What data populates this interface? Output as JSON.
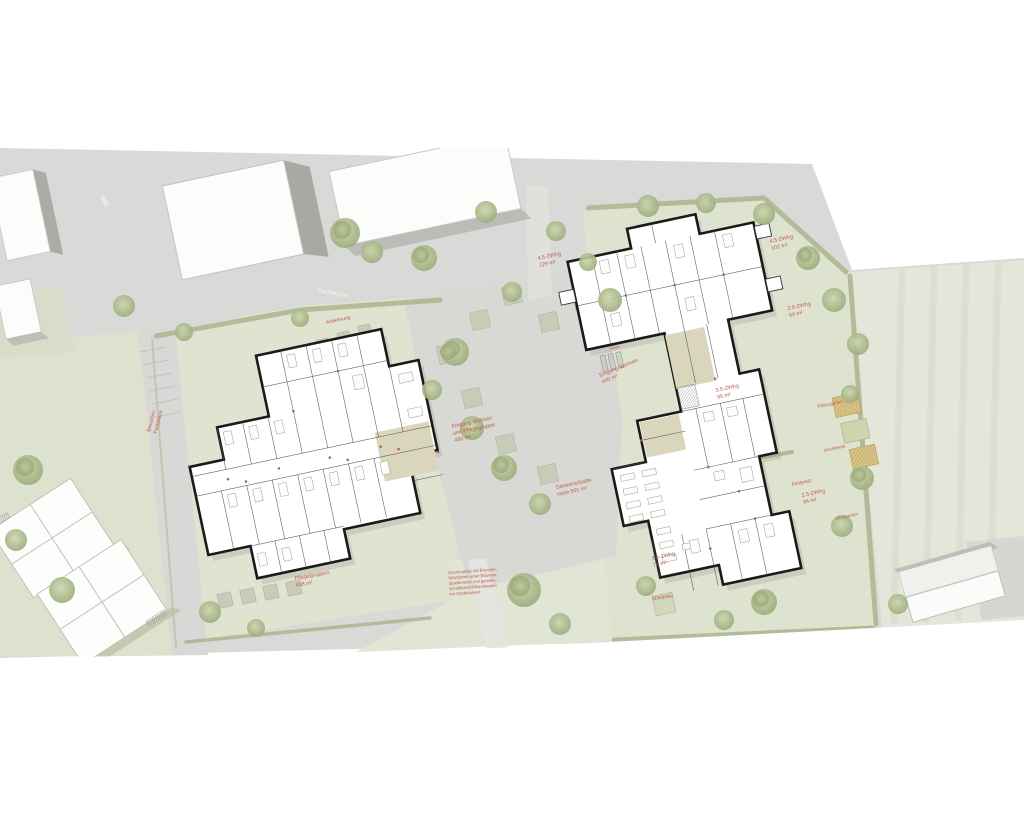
{
  "plan": {
    "street": {
      "name": "Bachstrasse",
      "marking": "460"
    },
    "apartments": [
      {
        "type": "4.5-ZWhg",
        "area": "129 m²"
      },
      {
        "type": "4.5-ZWhg",
        "area": "102 m²"
      },
      {
        "type": "2.5-ZWhg",
        "area": "64 m²"
      },
      {
        "type": "3.5-ZWhg",
        "area": "95 m²"
      },
      {
        "type": "2.5-ZWhg",
        "area": "94 m²"
      },
      {
        "type": "3.5-ZWhg",
        "area": "76 m²"
      }
    ],
    "entrances": {
      "e1": [
        "Eingang Wohnen",
        "und Pflegegruppe",
        "460 m²"
      ],
      "e2": [
        "Eingang Wohnen",
        "440 m²"
      ]
    },
    "facilities": {
      "gemeinschaft": [
        "Gemeinschafts-",
        "raum 501 m²"
      ],
      "pflege": [
        "Pflegegruppen",
        "638 m²"
      ]
    },
    "site": {
      "festplatz": "Festplatz",
      "spielplatz": "Spielplatz",
      "anlieferung": "Anlieferung",
      "velos": "Velos",
      "besucher": [
        "Besucher-",
        "Parkplätze"
      ],
      "gaerten": [
        "Pflanzgärten",
        "Hochbeete",
        "Obstgarten"
      ]
    },
    "note": [
      "Quartierplatz mit Brunnen,",
      "Sitzplätzen unter Bäumen,",
      "Spielbereich und gemein-",
      "schaftlichen Pflanzbeeten",
      "mit Obstbäumen"
    ]
  },
  "colors": {
    "annotation_red": "#bf5a4d",
    "lawn_green": "#dfe3d0",
    "pavement_gray": "#d9d9d7",
    "wall_black": "#1a1a1a",
    "entry_beige": "#d9d6bb"
  }
}
